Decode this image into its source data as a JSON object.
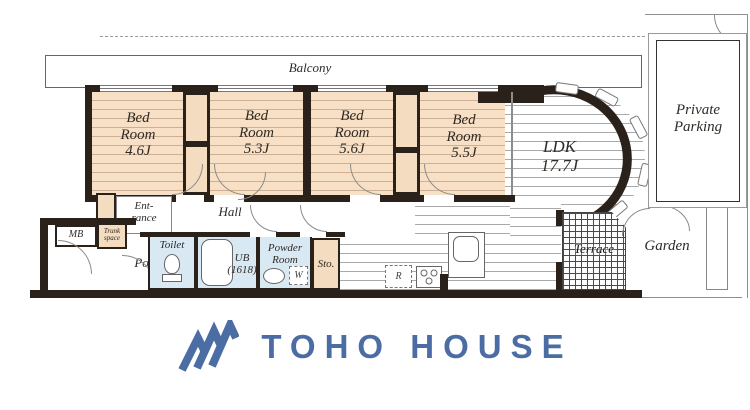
{
  "plan": {
    "balcony": "Balcony",
    "bedrooms": [
      {
        "l1": "Bed",
        "l2": "Room",
        "size": "4.6J"
      },
      {
        "l1": "Bed",
        "l2": "Room",
        "size": "5.3J"
      },
      {
        "l1": "Bed",
        "l2": "Room",
        "size": "5.6J"
      },
      {
        "l1": "Bed",
        "l2": "Room",
        "size": "5.5J"
      }
    ],
    "ldk": {
      "name": "LDK",
      "size": "17.7J"
    },
    "hall": "Hall",
    "entrance": {
      "l1": "Ent-",
      "l2": "rance"
    },
    "porch": "Porch",
    "mb": "MB",
    "trunk": {
      "l1": "Trunk",
      "l2": "space"
    },
    "toilet": "Toilet",
    "ub": {
      "l1": "UB",
      "l2": "(1618)"
    },
    "powder": {
      "l1": "Powder",
      "l2": "Room"
    },
    "sto": "Sto.",
    "terrace": "Terrace",
    "garden": "Garden",
    "parking": {
      "l1": "Private",
      "l2": "Parking"
    },
    "fridge": "R",
    "washer": "W"
  },
  "branding": {
    "logo": "TOHO HOUSE"
  },
  "colors": {
    "wall": "#2b211b",
    "bedroom_floor": "#f8e0c6",
    "wet_room": "#d9e9f3",
    "closet": "#f4dcc0",
    "logo_blue": "#4b6da3"
  }
}
